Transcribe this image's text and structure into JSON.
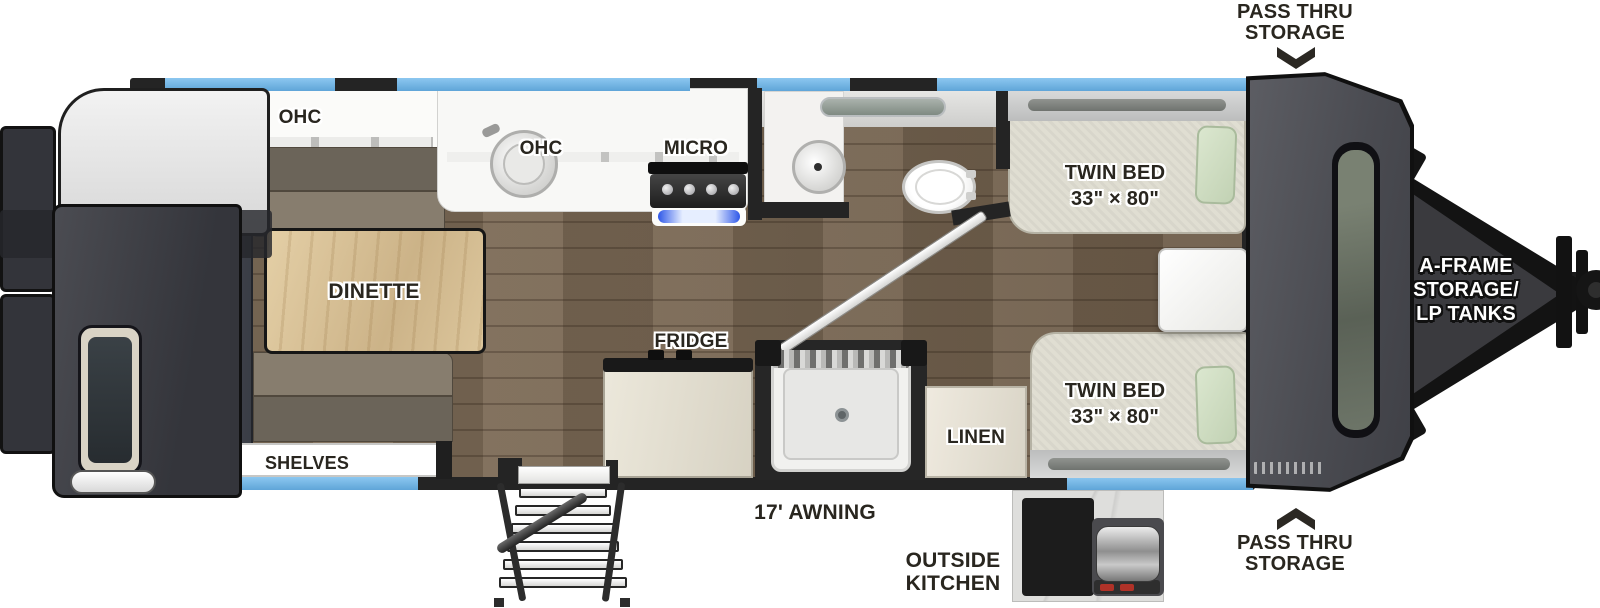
{
  "title": "Travel trailer floor plan",
  "colors": {
    "window_blue": "#74b7ea",
    "wall_dark": "#242424",
    "floor_wood": "#7a6955",
    "table_wood": "#d9c49c",
    "mattress": "#e0ded2",
    "pillow_green": "#cfdec6",
    "bench_gray": "#847b6d",
    "cabinet_white": "#f8f8f6",
    "front_cap_gray": "#4a4b51",
    "label_ink": "#29261f"
  },
  "rooms": {
    "rear_ohc": "OHC",
    "kitchen_ohc": "OHC",
    "micro": "MICRO",
    "dinette": "DINETTE",
    "shelves": "SHELVES",
    "fridge": "FRIDGE",
    "linen": "LINEN",
    "bed_top": [
      "TWIN BED",
      "33\" × 80\""
    ],
    "bed_bottom": [
      "TWIN BED",
      "33\" × 80\""
    ]
  },
  "callouts": {
    "pass_thru_top": [
      "PASS THRU",
      "STORAGE"
    ],
    "pass_thru_bottom": [
      "PASS THRU",
      "STORAGE"
    ],
    "a_frame": [
      "A-FRAME",
      "STORAGE/",
      "LP TANKS"
    ],
    "awning": "17' AWNING",
    "outside_kitchen": [
      "OUTSIDE",
      "KITCHEN"
    ]
  }
}
